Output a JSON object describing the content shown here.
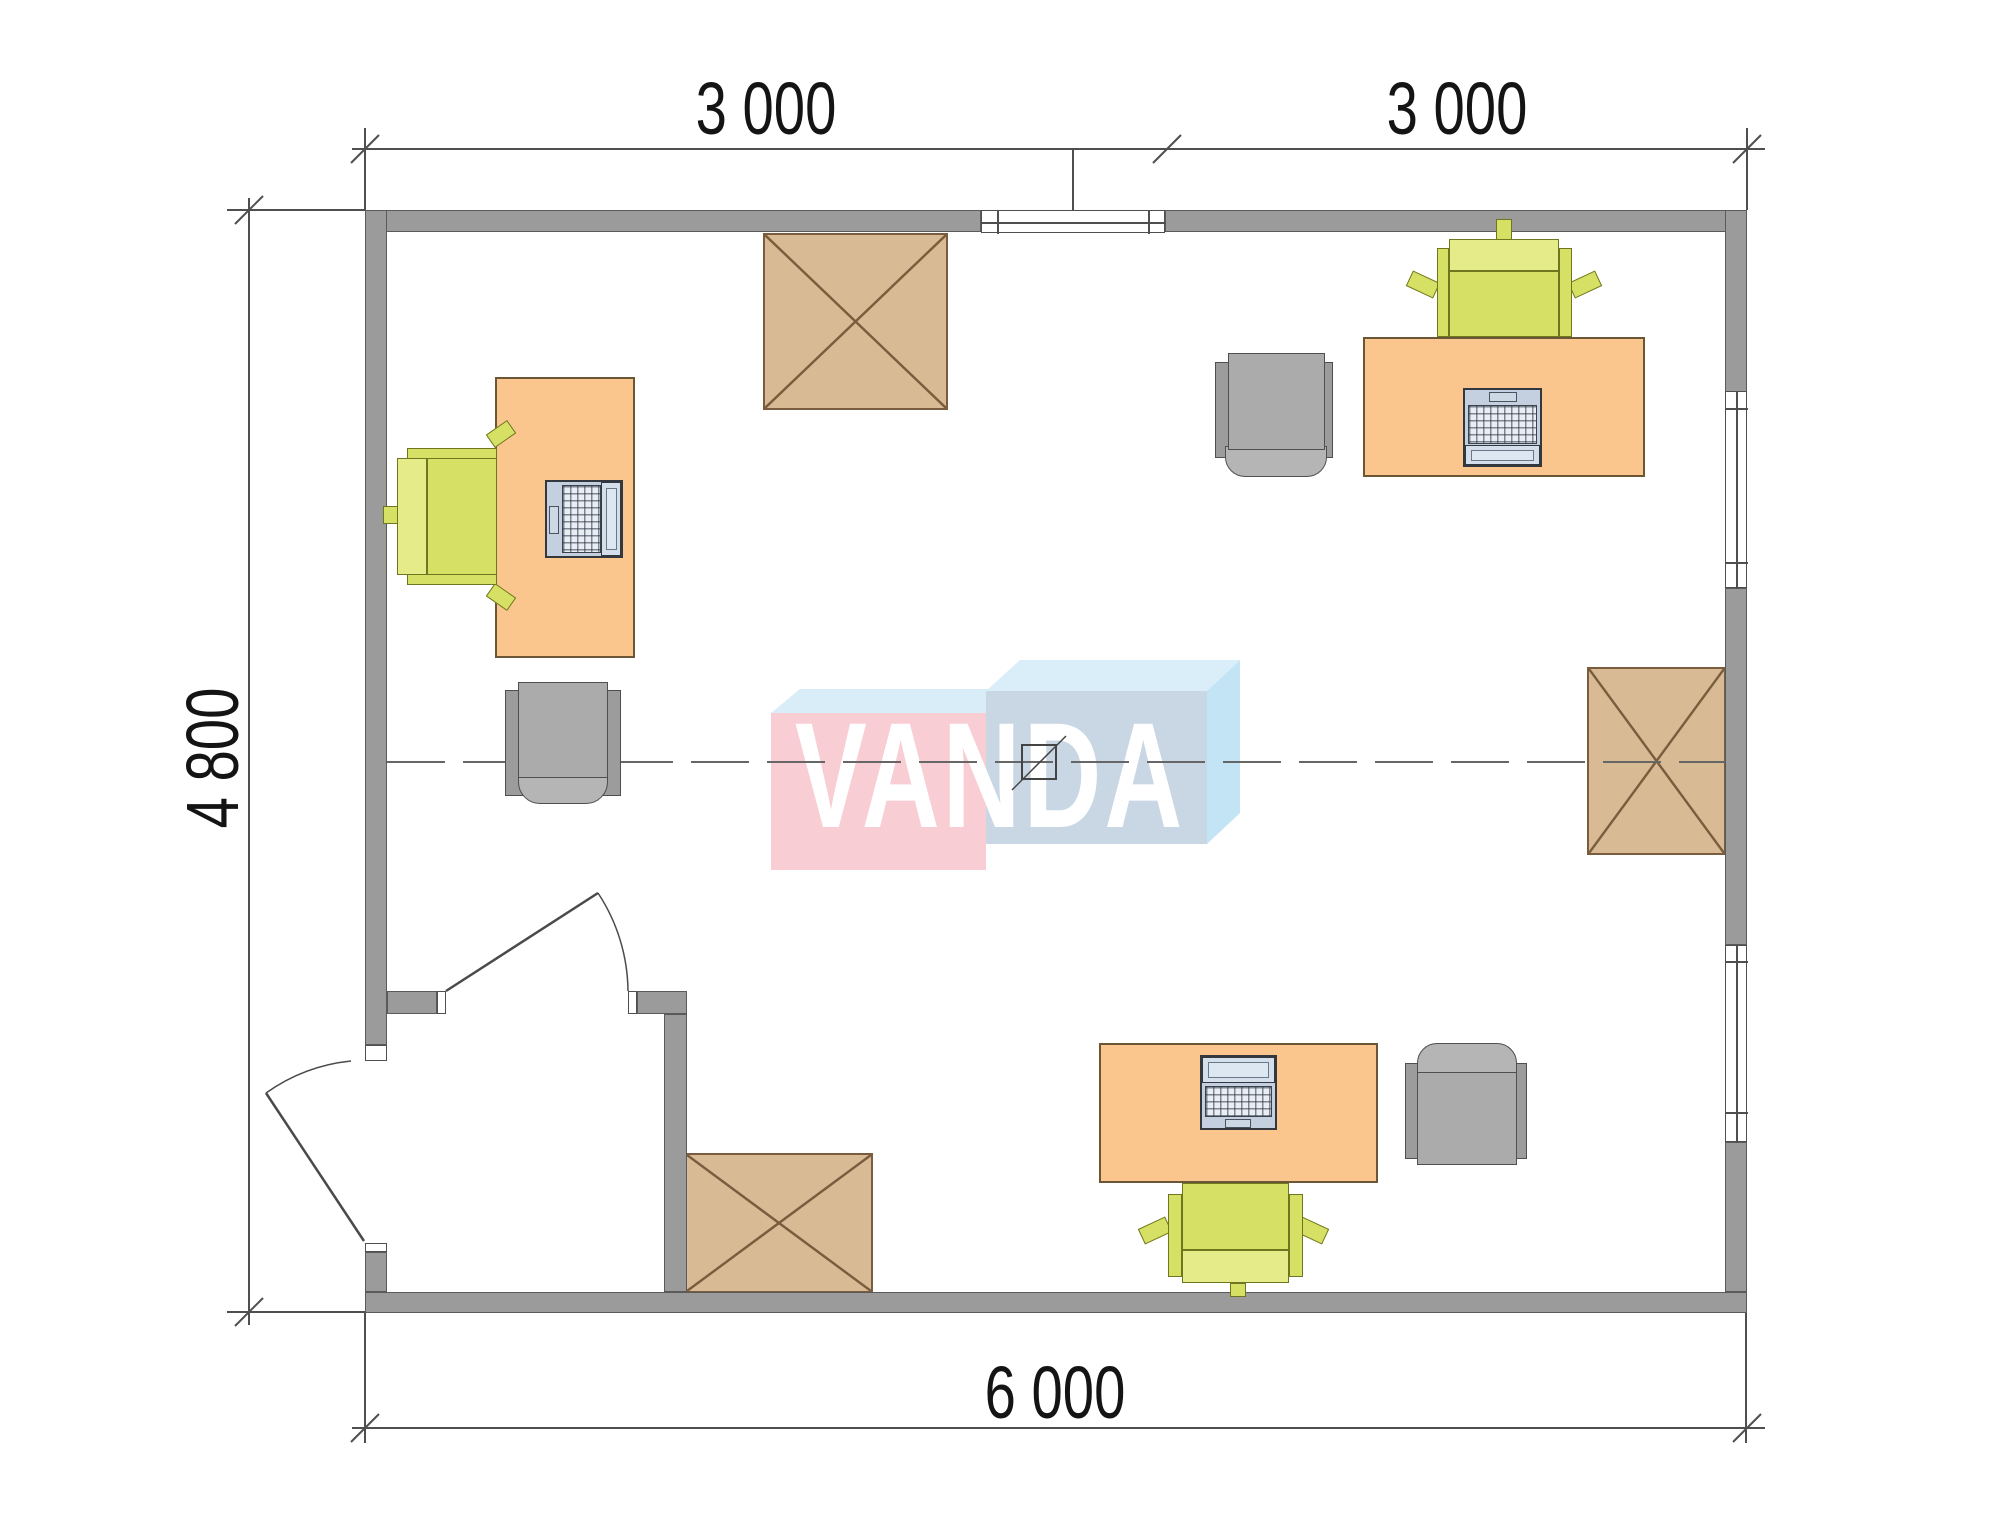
{
  "drawing": {
    "type": "office floor plan",
    "dimensions": {
      "top_segment_1": "3 000",
      "top_segment_2": "3 000",
      "side_height": "4 800",
      "bottom_total": "6 000"
    },
    "watermark": {
      "text": "VANDA"
    },
    "furniture": {
      "desks": 3,
      "office_chairs": 3,
      "armchairs": 3,
      "crossed_cabinets": 3,
      "laptops": 3,
      "windows": 3,
      "doors": 2
    },
    "colors": {
      "wall": "#9b9b9b",
      "wall_outline": "#5a5a5a",
      "dim_line": "#4f4f4f",
      "dim_text": "#141414",
      "desk": "#fbc68d",
      "desk_outline": "#6b5636",
      "chair_seat": "#d6e065",
      "chair_back": "#e4eb88",
      "chair_outline": "#70761f",
      "armchair_seat": "#ababab",
      "armchair_wing": "#9c9c9c",
      "armchair_front": "#b5b5b5",
      "armchair_outline": "#4f4f4f",
      "cabinet": "#d8bb94",
      "cabinet_outline": "#7a5c3e",
      "laptop_body": "#c4cfdf",
      "laptop_screen": "#d3dfeb",
      "laptop_outline": "#33383f",
      "logo_pink": "#f8cdd4",
      "logo_pink_top": "#d9edf9",
      "logo_blue": "#c9d7e4",
      "logo_blue_top": "#daeefa",
      "logo_blue_side": "#c2e4f5",
      "logo_text": "#ffffff",
      "centerline": "#666666"
    }
  }
}
